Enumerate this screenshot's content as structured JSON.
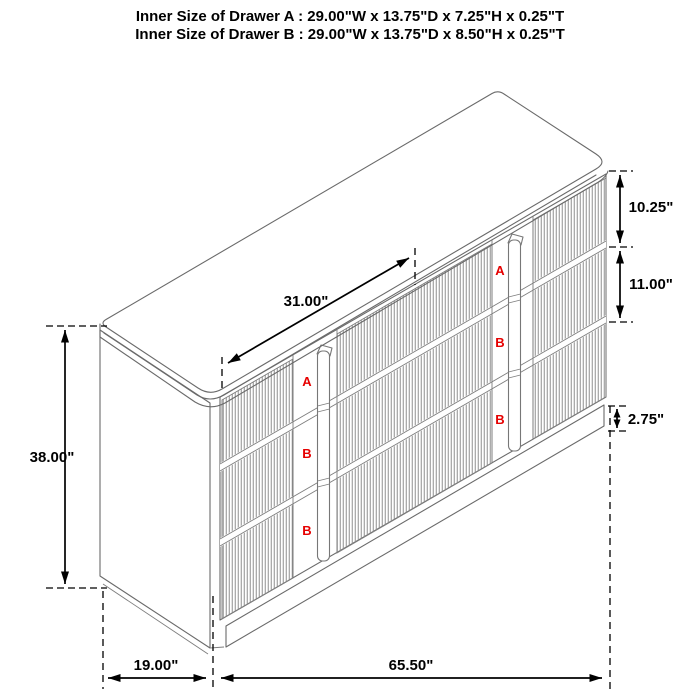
{
  "title": {
    "line1": "Inner Size of Drawer A : 29.00\"W x 13.75\"D x 7.25\"H x 0.25\"T",
    "line2": "Inner Size of Drawer B : 29.00\"W x 13.75\"D x 8.50\"H x 0.25\"T"
  },
  "dimensions": {
    "top_width": "31.00\"",
    "overall_height": "38.00\"",
    "drawer_a_front_height": "10.25\"",
    "drawer_b_front_height": "11.00\"",
    "base_height": "2.75\"",
    "depth": "19.00\"",
    "width": "65.50\""
  },
  "drawer_labels": {
    "left_column": [
      "A",
      "B",
      "B"
    ],
    "right_column": [
      "A",
      "B",
      "B"
    ]
  },
  "colors": {
    "label_red": "#e60000",
    "dimension_black": "#000000",
    "cabinet_line_gray": "#6a6a6a",
    "flute_gray": "#8f8f8f"
  }
}
